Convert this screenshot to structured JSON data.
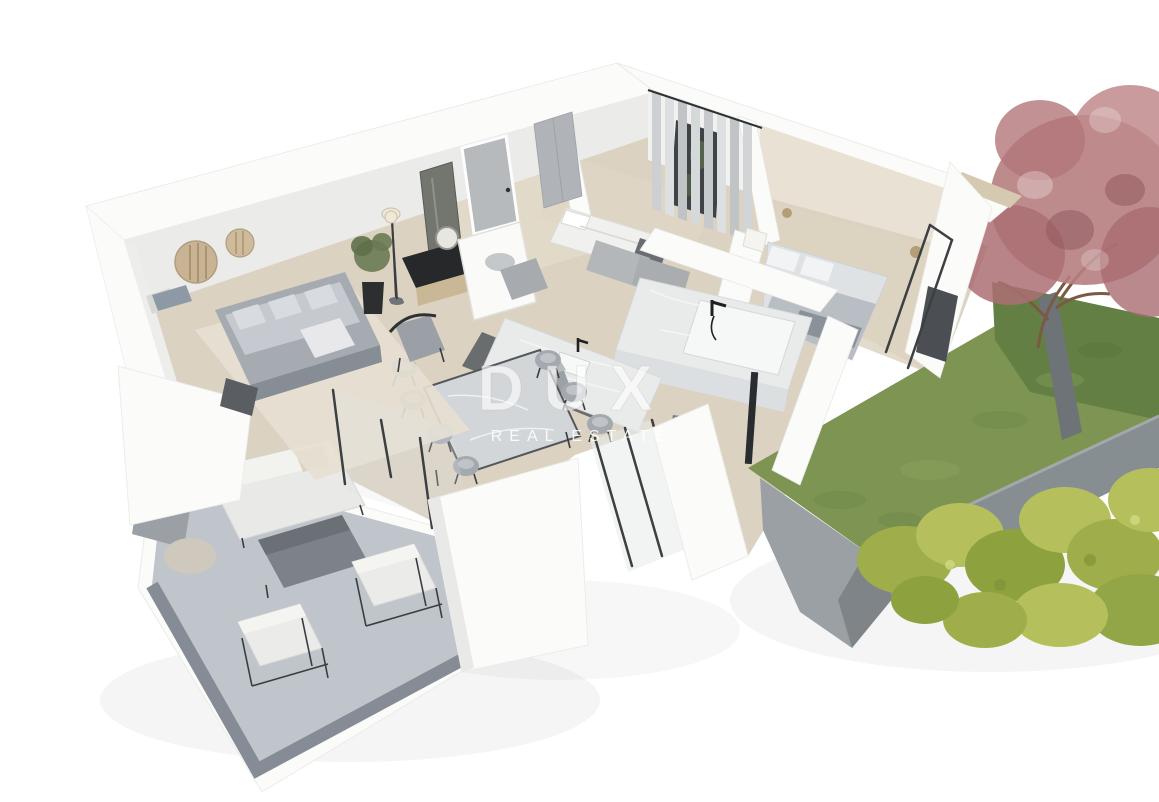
{
  "watermark": {
    "brand": "DUX",
    "tagline": "REAL ESTATE"
  },
  "scene": {
    "description": "Isometric 3D cutaway rendering of a furnished apartment: living room with grey sofa, dining table with eight chairs, kitchen, marble bathroom, two bedrooms, covered concrete terrace with outdoor lounge furniture, raised lawn garden with ornamental red tree and yellow-green shrubs, on a white background."
  },
  "palette": {
    "background": "#ffffff",
    "wall": "#fbfbf9",
    "wall_shade": "#ebebe9",
    "wood_floor": "#dbd2c2",
    "hall_floor": "#e4dccb",
    "terrace_concrete": "#bfc5cb",
    "concrete_dark": "#878e92",
    "lawn": "#7d9452",
    "lawn_shadow": "#637f44",
    "shrub": "#b5c05c",
    "tree_foliage": "#b67e80",
    "marble": "#e9ebeb",
    "furniture_gray": "#a6abb2",
    "frame_dark": "#3c4043",
    "accent_wood": "#c9b795",
    "brass": "#b49e78",
    "headboard_cream": "#e9e1d3"
  }
}
